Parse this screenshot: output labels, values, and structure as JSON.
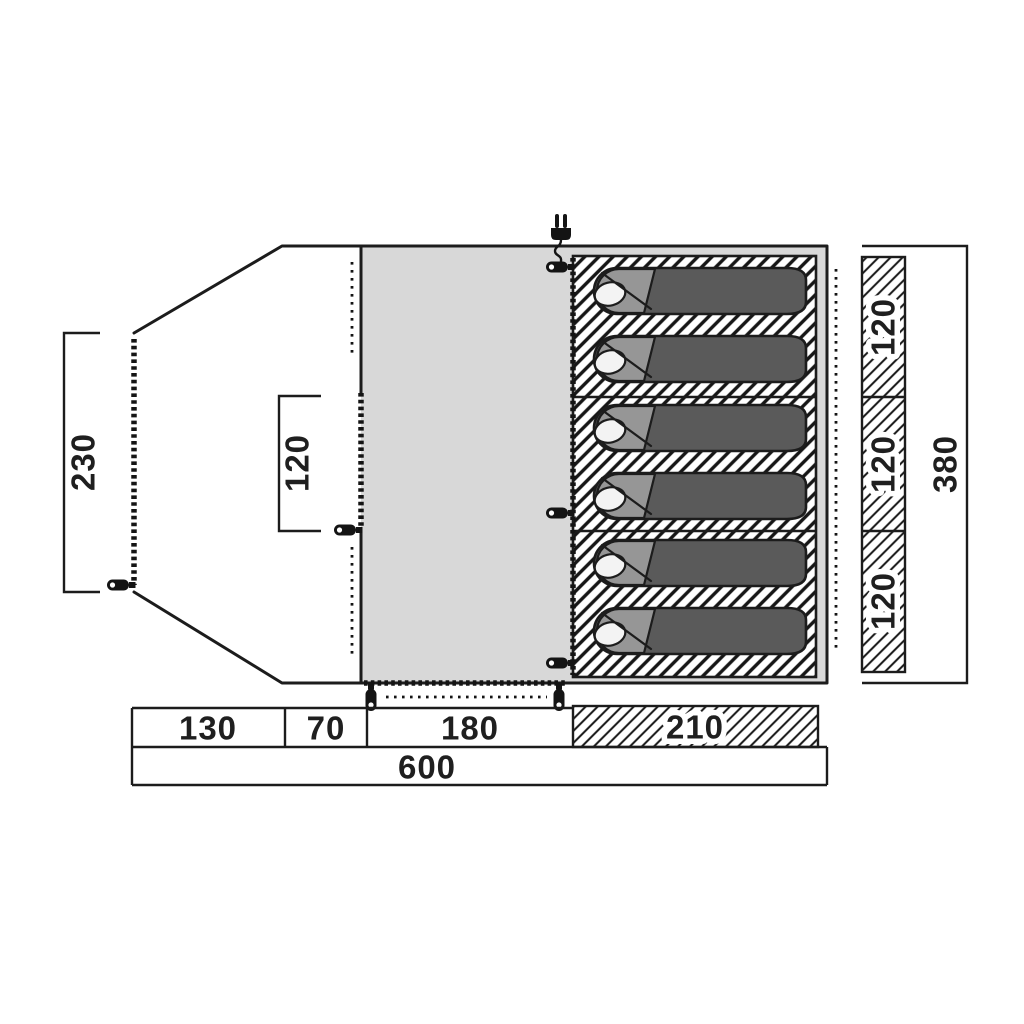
{
  "diagram": {
    "kind": "tent-floorplan",
    "dimensions": {
      "porch_depth": "230",
      "porch_door_width": "120",
      "porch_front_length": "130",
      "porch_rear_length": "70",
      "living_area_length": "180",
      "sleeping_area_length": "210",
      "total_length": "600",
      "berth_widths": [
        "120",
        "120",
        "120"
      ],
      "inner_width": "380"
    },
    "features": {
      "sleeping_bag_count": 6,
      "power_inlet_icon": "power-plug-icon",
      "zipper_pull_icon": "zipper-pull-icon"
    },
    "colors": {
      "background": "#ffffff",
      "outline": "#1c1c1c",
      "floor": "#d8d8d8",
      "sleeping_bag_body": "#5a5a5a",
      "sleeping_bag_hood": "#969696",
      "pillow": "#f3f3f3"
    }
  }
}
